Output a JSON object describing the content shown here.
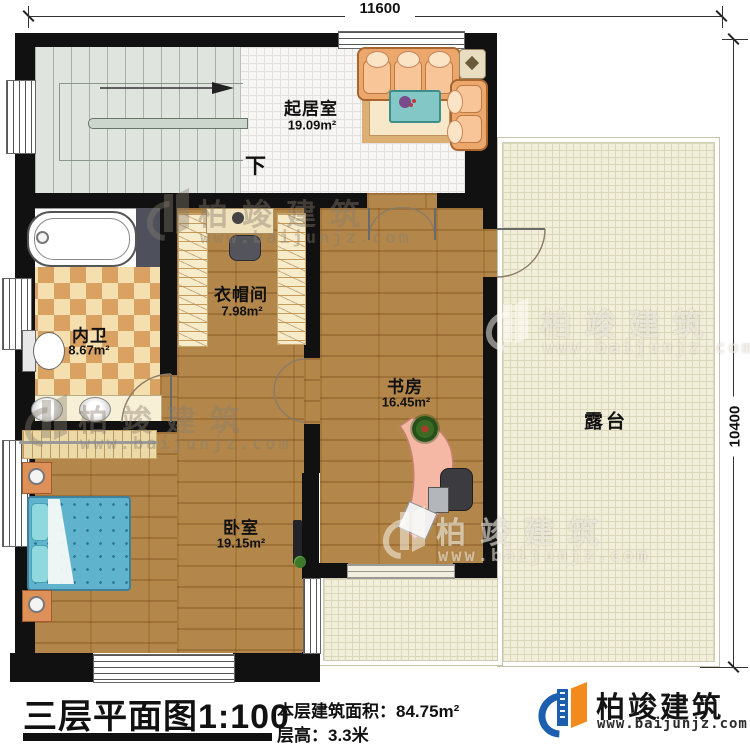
{
  "dimensions": {
    "width_label": "11600",
    "height_label": "10400"
  },
  "rooms": {
    "living": {
      "name": "起居室",
      "area": "19.09m²"
    },
    "stairs": {
      "down": "下"
    },
    "bath": {
      "name": "内卫",
      "area": "8.67m²"
    },
    "closet": {
      "name": "衣帽间",
      "area": "7.98m²"
    },
    "study": {
      "name": "书房",
      "area": "16.45m²"
    },
    "bedroom": {
      "name": "卧室",
      "area": "19.15m²"
    },
    "terrace": {
      "name": "露台"
    }
  },
  "footer": {
    "plan_title": "三层平面图",
    "plan_scale": "1:100",
    "area_text": "本层建筑面积：84.75m²",
    "floor_height_text": "层高：3.3米"
  },
  "brand": {
    "name": "柏竣建筑",
    "website": "www.baijunjz.com"
  },
  "watermark": {
    "name": "柏竣建筑",
    "website": "www.baijunjz.com"
  },
  "colors": {
    "wall": "#111111",
    "wood": "#a97a3c",
    "stair_floor": "#dfe5de",
    "tile": "#f6f5f3",
    "terrace": "#f1eeda",
    "checker_tan": "#d9a263",
    "brand_blue": "#1c5fae",
    "brand_orange": "#f28a1e"
  }
}
